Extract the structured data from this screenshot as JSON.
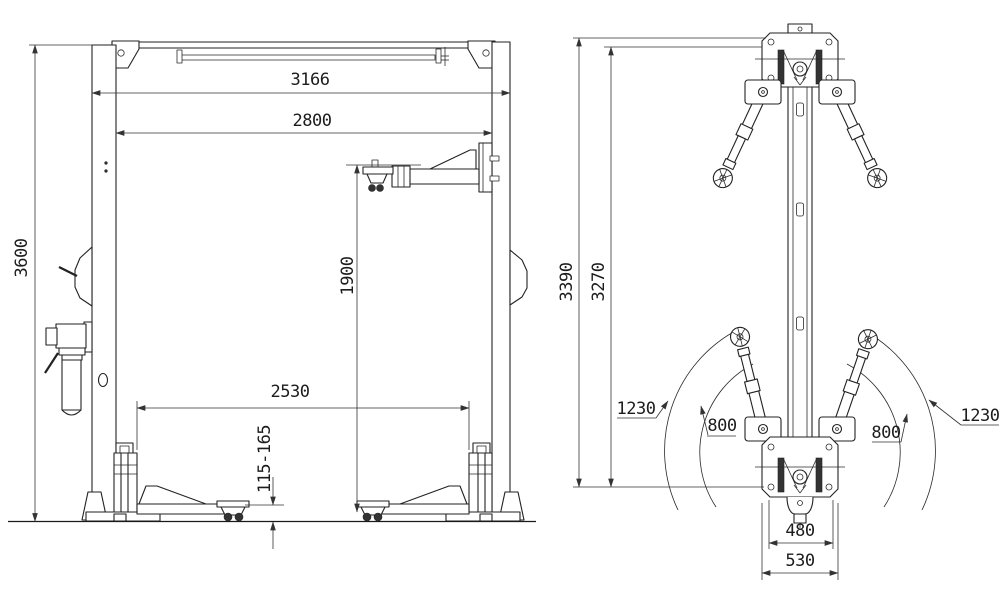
{
  "drawing": {
    "background": "#ffffff",
    "line_color": "#222222",
    "front_view": {
      "description": "two-post car lift front elevation",
      "dim_total_height": "3600",
      "dim_overall_width": "3166",
      "dim_inside_width": "2800",
      "dim_max_lift_height": "1900",
      "dim_between_carriages": "2530",
      "dim_pad_height_range": "115-165"
    },
    "plan_view": {
      "description": "column plan view with arm swing radii",
      "dim_height_overall": "3390",
      "dim_height_secondary": "3270",
      "dim_arm_reach_max_left": "1230",
      "dim_arm_reach_min_left": "800",
      "dim_arm_reach_min_right": "800",
      "dim_arm_reach_max_right": "1230",
      "dim_base_bolt_spacing": "480",
      "dim_base_plate_width": "530"
    }
  }
}
